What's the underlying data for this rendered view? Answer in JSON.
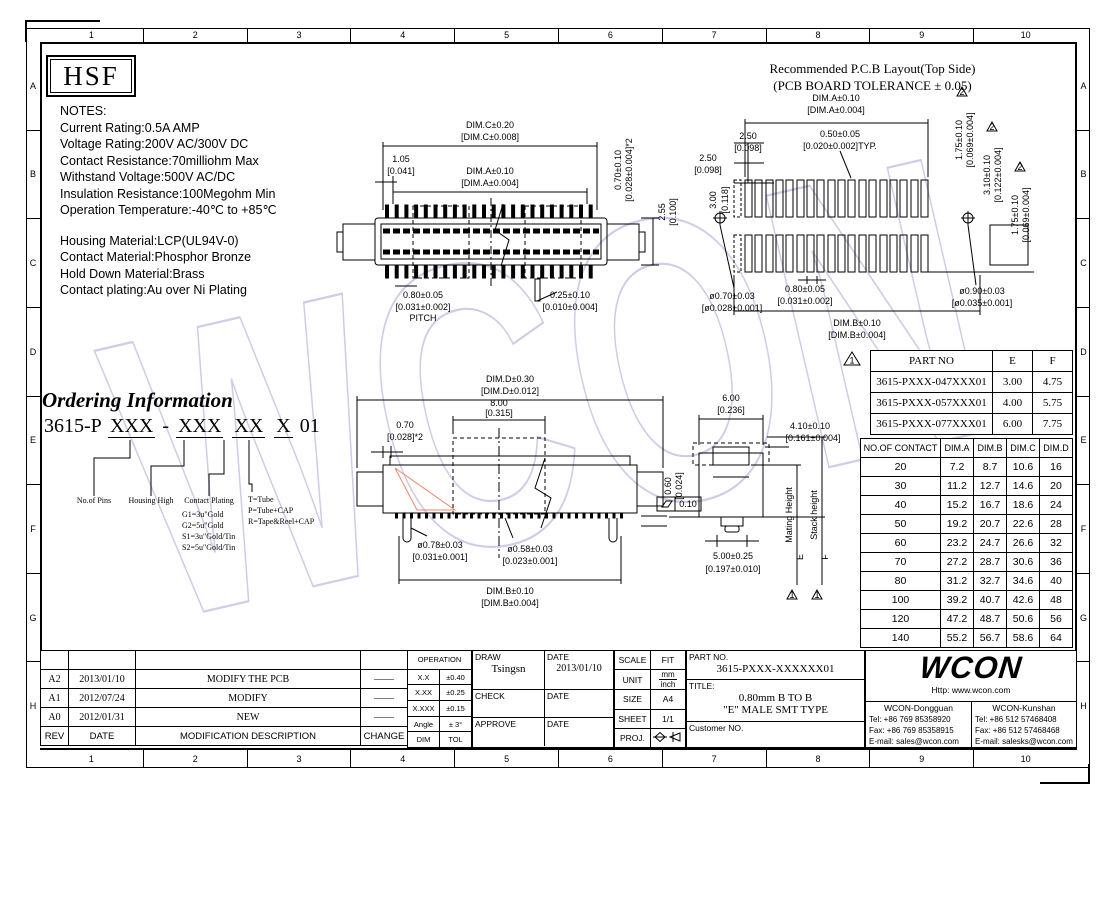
{
  "colors": {
    "line": "#000000",
    "watermark": "#c5c5e5",
    "highlight_triangle": "#f08568"
  },
  "sheet": {
    "watermark": "WCON",
    "logo": "HSF",
    "grid_cols": [
      "1",
      "2",
      "3",
      "4",
      "5",
      "6",
      "7",
      "8",
      "9",
      "10"
    ],
    "grid_rows": [
      "A",
      "B",
      "C",
      "D",
      "E",
      "F",
      "G",
      "H"
    ]
  },
  "notes": {
    "title": "NOTES:",
    "lines1": [
      "Current Rating:0.5A AMP",
      "Voltage Rating:200V AC/300V DC",
      "Contact Resistance:70milliohm Max",
      "Withstand Voltage:500V AC/DC",
      "Insulation Resistance:100Megohm Min",
      "Operation Temperature:-40℃ to +85℃"
    ],
    "lines2": [
      "Housing Material:LCP(UL94V-0)",
      "Contact Material:Phosphor Bronze",
      "Hold Down Material:Brass",
      "Contact plating:Au over Ni Plating"
    ]
  },
  "pcb_layout": {
    "title1": "Recommended P.C.B Layout(Top Side)",
    "title2": "(PCB BOARD TOLERANCE ± 0.05)",
    "dim_a1": "DIM.A±0.10",
    "dim_a2": "[DIM.A±0.004]",
    "typ1": "0.50±0.05",
    "typ2": "[0.020±0.002]TYP.",
    "s250": "2.50",
    "s250b": "[0.098]",
    "s300": "3.00",
    "s300b": "[0.118]",
    "via_l1": "ø0.70±0.03",
    "via_l2": "[ø0.028±0.001]",
    "pitch1": "0.80±0.05",
    "pitch2": "[0.031±0.002]",
    "dim_b1": "DIM.B±0.10",
    "dim_b2": "[DIM.B±0.004]",
    "via_r1": "ø0.90±0.03",
    "via_r2": "[ø0.035±0.001]",
    "v175a": "1.75±0.10",
    "v175b": "[0.069±0.004]",
    "v310a": "3.10±0.10",
    "v310b": "[0.122±0.004]",
    "flag": "2"
  },
  "top_view": {
    "dim_c1": "DIM.C±0.20",
    "dim_c2": "[DIM.C±0.008]",
    "s105a": "1.05",
    "s105b": "[0.041]",
    "dim_a1": "DIM.A±0.10",
    "dim_a2": "[DIM.A±0.004]",
    "pitch1": "0.80±0.05",
    "pitch2": "[0.031±0.002]",
    "pitch3": "PITCH",
    "s025a": "0.25±0.10",
    "s025b": "[0.010±0.004]",
    "v070a": "0.70±0.10",
    "v070b": "[0.028±0.004]*2",
    "v255a": "2.55",
    "v255b": "[0.100]"
  },
  "front_view": {
    "dim_d1": "DIM.D±0.30",
    "dim_d2": "[DIM.D±0.012]",
    "s800a": "8.00",
    "s800b": "[0.315]",
    "s070a": "0.70",
    "s070b": "[0.028]*2",
    "v060a": "0.60",
    "v060b": "[0.024]",
    "d078a": "ø0.78±0.03",
    "d078b": "[0.031±0.001]",
    "d058a": "ø0.58±0.03",
    "d058b": "[0.023±0.001]",
    "dim_b1": "DIM.B±0.10",
    "dim_b2": "[DIM.B±0.004]"
  },
  "side_view": {
    "s600a": "6.00",
    "s600b": "[0.236]",
    "s410a": "4.10±0.10",
    "s410b": "[0.161±0.004]",
    "s500a": "5.00±0.25",
    "s500b": "[0.197±0.010]",
    "flatness": "0.10",
    "mating": "Mating Height",
    "mating_ref": "E",
    "stack": "Stack height",
    "stack_ref": "F",
    "flag": "1"
  },
  "ordering": {
    "heading": "Ordering Information",
    "prefix": "3615-P",
    "group1": "XXX",
    "sep": "-",
    "group2": "XXX",
    "group3": "XX",
    "group4": "X",
    "suffix": "01",
    "label_pins": "No.of Pins",
    "label_housing": "Housing High",
    "label_plating": "Contact Plating",
    "plating_options": [
      "G1=3u\"Gold",
      "G2=5u\"Gold",
      "S1=3u\"Gold/Tin",
      "S2=5u\"Gold/Tin"
    ],
    "packing_options": [
      "T=Tube",
      "P=Tube+CAP",
      "R=Tape&Reel+CAP"
    ]
  },
  "part_table": {
    "flag": "1",
    "headers": [
      "PART NO",
      "E",
      "F"
    ],
    "rows": [
      [
        "3615-PXXX-047XXX01",
        "3.00",
        "4.75"
      ],
      [
        "3615-PXXX-057XXX01",
        "4.00",
        "5.75"
      ],
      [
        "3615-PXXX-077XXX01",
        "6.00",
        "7.75"
      ]
    ]
  },
  "contact_table": {
    "headers": [
      "NO.OF CONTACT",
      "DIM.A",
      "DIM.B",
      "DIM.C",
      "DIM.D"
    ],
    "rows": [
      [
        "20",
        "7.2",
        "8.7",
        "10.6",
        "16"
      ],
      [
        "30",
        "11.2",
        "12.7",
        "14.6",
        "20"
      ],
      [
        "40",
        "15.2",
        "16.7",
        "18.6",
        "24"
      ],
      [
        "50",
        "19.2",
        "20.7",
        "22.6",
        "28"
      ],
      [
        "60",
        "23.2",
        "24.7",
        "26.6",
        "32"
      ],
      [
        "70",
        "27.2",
        "28.7",
        "30.6",
        "36"
      ],
      [
        "80",
        "31.2",
        "32.7",
        "34.6",
        "40"
      ],
      [
        "100",
        "39.2",
        "40.7",
        "42.6",
        "48"
      ],
      [
        "120",
        "47.2",
        "48.7",
        "50.6",
        "56"
      ],
      [
        "140",
        "55.2",
        "56.7",
        "58.6",
        "64"
      ]
    ]
  },
  "revision_table": {
    "rows": [
      [
        "",
        "",
        "",
        ""
      ],
      [
        "A2",
        "2013/01/10",
        "MODIFY THE PCB",
        "——"
      ],
      [
        "A1",
        "2012/07/24",
        "MODIFY",
        "——"
      ],
      [
        "A0",
        "2012/01/31",
        "NEW",
        "——"
      ],
      [
        "REV",
        "DATE",
        "MODIFICATION DESCRIPTION",
        "CHANGE"
      ]
    ]
  },
  "tolerance_table": {
    "title": "OPERATION",
    "rows": [
      [
        "X.X",
        "±0.40"
      ],
      [
        "X.XX",
        "±0.25"
      ],
      [
        "X.XXX",
        "±0.15"
      ],
      [
        "Angle",
        "± 3°"
      ]
    ],
    "footer": [
      "DIM",
      "TOL"
    ]
  },
  "title_block": {
    "draw_label": "DRAW",
    "draw_name": "Tsingsn",
    "date_label": "DATE",
    "draw_date": "2013/01/10",
    "check_label": "CHECK",
    "approve_label": "APPROVE",
    "scale_label": "SCALE",
    "scale_value": "FIT",
    "unit_label": "UNIT",
    "unit_mm": "mm",
    "unit_inch": "inch",
    "size_label": "SIZE",
    "size_value": "A4",
    "sheet_label": "SHEET",
    "sheet_value": "1/1",
    "proj_label": "PROJ.",
    "partno_label": "PART NO.",
    "partno_value": "3615-PXXX-XXXXXX01",
    "title_label": "TITLE:",
    "title_line1": "0.80mm B TO B",
    "title_line2": "\"E\" MALE SMT TYPE",
    "customer_label": "Customer NO.",
    "logo": "WCON",
    "website": "Http: www.wcon.com",
    "offices": [
      {
        "name": "WCON-Dongguan",
        "tel": "Tel: +86 769 85358920",
        "fax": "Fax: +86 769 85358915",
        "email": "E-mail: sales@wcon.com"
      },
      {
        "name": "WCON-Kunshan",
        "tel": "Tel: +86 512 57468408",
        "fax": "Fax: +86 512 57468468",
        "email": "E-mail: salesks@wcon.com"
      }
    ]
  }
}
